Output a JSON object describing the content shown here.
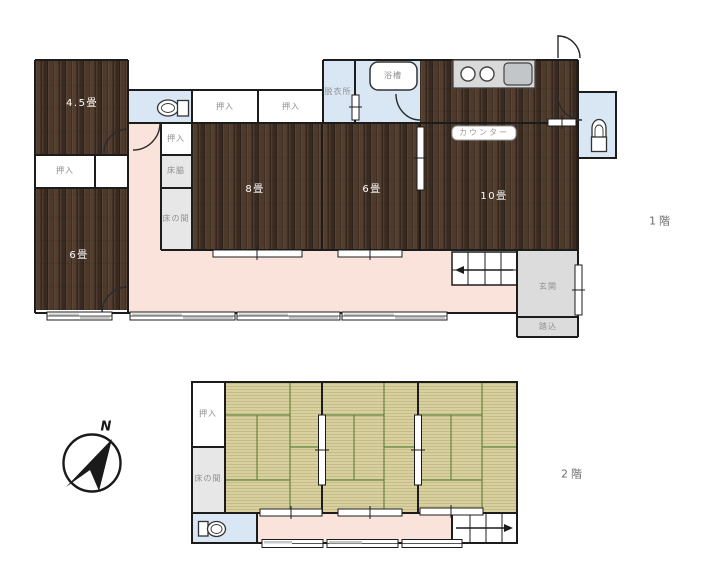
{
  "floor1": {
    "title": "1階",
    "labels": {
      "room_4_5": "4.5畳",
      "room_8": "8畳",
      "room_6_center": "6畳",
      "room_6_left": "6畳",
      "room_10": "10畳",
      "closet": "押入",
      "tokowaki": "床脇",
      "tokonoma": "床の間",
      "dressing_room": "脱衣所",
      "bathtub": "浴槽",
      "counter": "カウンター",
      "entrance": "玄関",
      "entrance_step": "踏込"
    }
  },
  "floor2": {
    "title": "2階",
    "labels": {
      "closet": "押入",
      "tokonoma": "床の間"
    }
  },
  "compass": {
    "north_label": "N"
  },
  "colors": {
    "wood_floor": "#46332a",
    "tatami": "#d9d0a0",
    "tatami_line": "#5d8437",
    "hallway_pink": "#fae3da",
    "wet_area_blue": "#d9e6f3",
    "entrance_gray": "#dcdcdc",
    "alcove_gray": "#e7e7e7",
    "wall": "#1c1c1c"
  },
  "icons": [
    "toilet-icon",
    "bathtub-icon",
    "stove-icon",
    "sink-icon",
    "stairs-icon",
    "compass-icon",
    "door-arc-icon",
    "sliding-door-icon",
    "window-icon"
  ]
}
